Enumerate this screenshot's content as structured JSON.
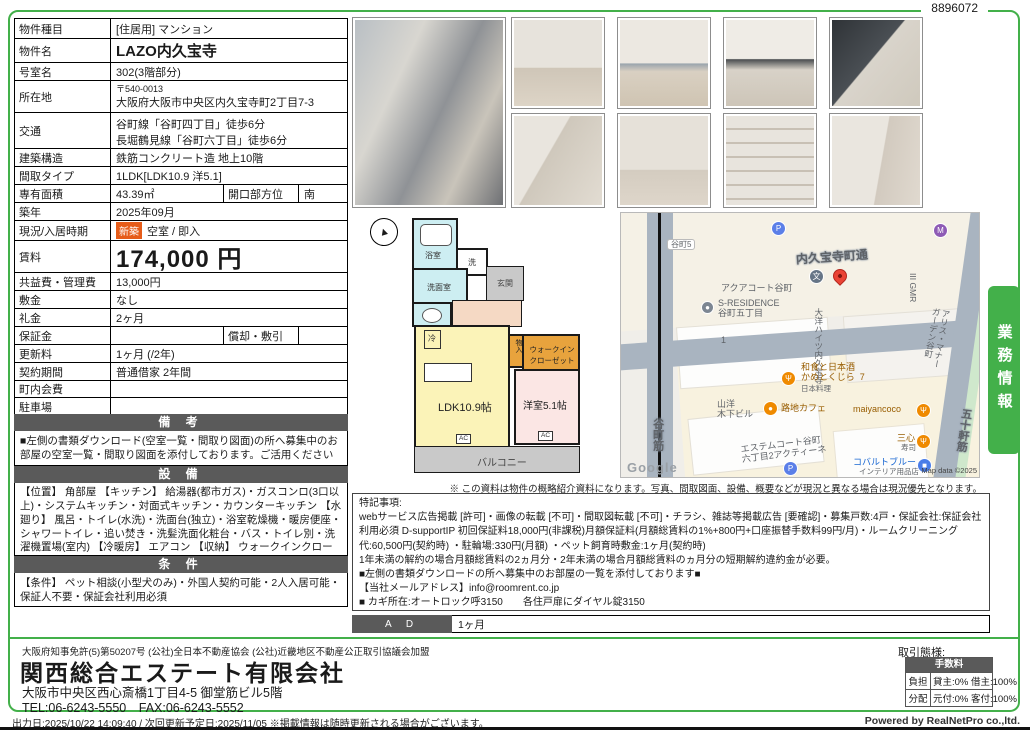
{
  "page": {
    "doc_number": "8896072",
    "side_tab": "業務情報",
    "footer_left": "出力日:2025/10/22 14:09:40 / 次回更新予定日:2025/11/05 ※掲載情報は随時更新される場合がございます。",
    "footer_right": "Powered by RealNetPro co.,ltd.",
    "colors": {
      "accent_green": "#43b04a",
      "bar_gray": "#5a5a5a",
      "badge_orange": "#e65c19"
    }
  },
  "table": {
    "rows": [
      {
        "label": "物件種目",
        "value": "[住居用] マンション"
      },
      {
        "label": "物件名",
        "value": "LAZO内久宝寺"
      },
      {
        "label": "号室名",
        "value": "302(3階部分)"
      },
      {
        "label": "所在地",
        "zip": "〒540-0013",
        "value": "大阪府大阪市中央区内久宝寺町2丁目7-3"
      },
      {
        "label": "交通",
        "line1": "谷町線「谷町四丁目」徒歩6分",
        "line2": "長堀鶴見線「谷町六丁目」徒歩6分"
      },
      {
        "label": "建築構造",
        "value": "鉄筋コンクリート造 地上10階"
      },
      {
        "label": "間取タイプ",
        "value": "1LDK[LDK10.9 洋5.1]"
      },
      {
        "label": "専有面積",
        "value": "43.39㎡",
        "label2": "開口部方位",
        "value2": "南"
      },
      {
        "label": "築年",
        "value": "2025年09月"
      },
      {
        "label": "現況/入居時期",
        "badge": "新築",
        "value": "空室 / 即入"
      },
      {
        "label": "賃料",
        "value": "174,000 円"
      },
      {
        "label": "共益費・管理費",
        "value": "13,000円"
      },
      {
        "label": "敷金",
        "value": "なし"
      },
      {
        "label": "礼金",
        "value": "2ヶ月"
      },
      {
        "label": "保証金",
        "value": "",
        "label2": "償却・敷引",
        "value2": ""
      },
      {
        "label": "更新料",
        "value": "1ヶ月 (/2年)"
      },
      {
        "label": "契約期間",
        "value": "普通借家 2年間"
      },
      {
        "label": "町内会費",
        "value": ""
      },
      {
        "label": "駐車場",
        "value": ""
      }
    ]
  },
  "sections": {
    "remarks": {
      "title": "備 考",
      "body": "■左側の書類ダウンロード(空室一覧・間取り図面)の所へ募集中のお部屋の空室一覧・間取り図面を添付しております。ご活用くださいませ。"
    },
    "equipment": {
      "title": "設 備",
      "body": "【位置】 角部屋 【キッチン】 給湯器(都市ガス)・ガスコンロ(3口以上)・システムキッチン・対面式キッチン・カウンターキッチン 【水廻り】 風呂・トイレ(水洗)・洗面台(独立)・浴室乾燥機・暖房便座・シャワートイレ・追い焚き・洗髪洗面化粧台・バス・トイレ別・洗濯機置場(室内) 【冷暖房】 エアコン 【収納】 ウォークインクローゼット・シューズボックス 【放送・通信】 BS・CS・光ファイバー・ケーブルTV・インターネット対応・ネット使用料不要 【セキュリティ】 オートロック・宅配BOX・防犯カメラ・インターホン(カメラ付き) 【その他】 専用ごみ置場・エレベーター(1基)・自転車置場・電気・ガス(都市ガス)・水道(公営)・バルコニー/ベランダ・24時間換気システム・フローリング"
    },
    "conditions": {
      "title": "条 件",
      "body": "【条件】 ペット相談(小型犬のみ)・外国人契約可能・2人入居可能・保証人不要・保証会社利用必須"
    }
  },
  "notes": {
    "body": "特記事項:\nwebサービス広告掲載 [許可]・画像の転載 [不可]・間取図転載 [不可]・チラシ、雑誌等掲載広告 [要確認]・募集戸数:4戸・保証会社:保証会社利用必須 D-supportIP 初回保証料18,000円(非課税)月額保証料(月額総賃料の1%+800円+口座振替手数料99円/月)・ルームクリーニング代:60,500円(契約時) ・駐輪場:330円(月額) ・ペット飼育時敷金:1ヶ月(契約時)\n1年未満の解約の場合月額総賃料の2ヵ月分・2年未満の場合月額総賃料のヵ月分の短期解約違約金が必要。\n■左側の書類ダウンロードの所へ募集中のお部屋の一覧を添付しております■\n【当社メールアドレス】info@roomrent.co.jp\n■ カギ所在:オートロック呼3150　　各住戸扉にダイヤル錠3150"
  },
  "map_note": "※ この資料は物件の概略紹介資料になります。写真、間取図面、設備、概要などが現況と異なる場合は現況優先となります。",
  "ad": {
    "label": "A D",
    "value": "1ヶ月"
  },
  "floorplan": {
    "compass": "▲",
    "bath": "浴室",
    "washer": "洗",
    "washroom": "洗面室",
    "entrance": "玄関",
    "fridge": "冷",
    "storage": "物入",
    "wic": "ウォークイン\nクローゼット",
    "ldk": "LDK10.9帖",
    "western": "洋室5.1帖",
    "balcony": "バルコニー",
    "ac": "AC"
  },
  "map": {
    "area_tag": "谷町5",
    "main_street": "内久宝寺町通",
    "street_left": "谷町筋",
    "street_right": "五十軒筋",
    "bldg_aqua": "アクアコート谷町",
    "bldg_sres": "S-RESIDENCE\n谷町五丁目",
    "block_no": "1",
    "bldg_taiyo": "大洋ハイツ内久宝寺",
    "bldg_gmr": "III GMR",
    "bldg_alice": "アリス・マナー\nガーデン谷町",
    "rest_kame": "和食と日本酒\nかめとくじら  7",
    "rest_kame_sub": "日本料理",
    "bldg_sanyo": "山洋\n木下ビル",
    "cafe": "路地カフェ",
    "rest_maiyan": "maiyancoco",
    "rest_sanshin": "三心",
    "rest_sanshin_sub": "寿司",
    "bldg_estem": "エステムコート谷町\n六丁目2アクティーネ",
    "shop_cobalt": "コバルトブルー",
    "shop_cobalt_sub": "インテリア用品店",
    "google": "Google",
    "map_data": "Map data ©2025",
    "p_letter": "P",
    "school": "文"
  },
  "company": {
    "license": "大阪府知事免許(5)第50207号 (公社)全日本不動産協会 (公社)近畿地区不動産公正取引協議会加盟",
    "name": "関西総合エステート有限会社",
    "address": "大阪市中央区西心斎橋1丁目4-5 御堂筋ビル5階",
    "tel_fax": "TEL:06-6243-5550　FAX:06-6243-5552"
  },
  "deal": {
    "title": "取引態様:",
    "header": "手数料",
    "rows": [
      {
        "label": "負担",
        "value": "貸主:0% 借主:100%"
      },
      {
        "label": "分配",
        "value": "元付:0% 客付:100%"
      }
    ]
  }
}
